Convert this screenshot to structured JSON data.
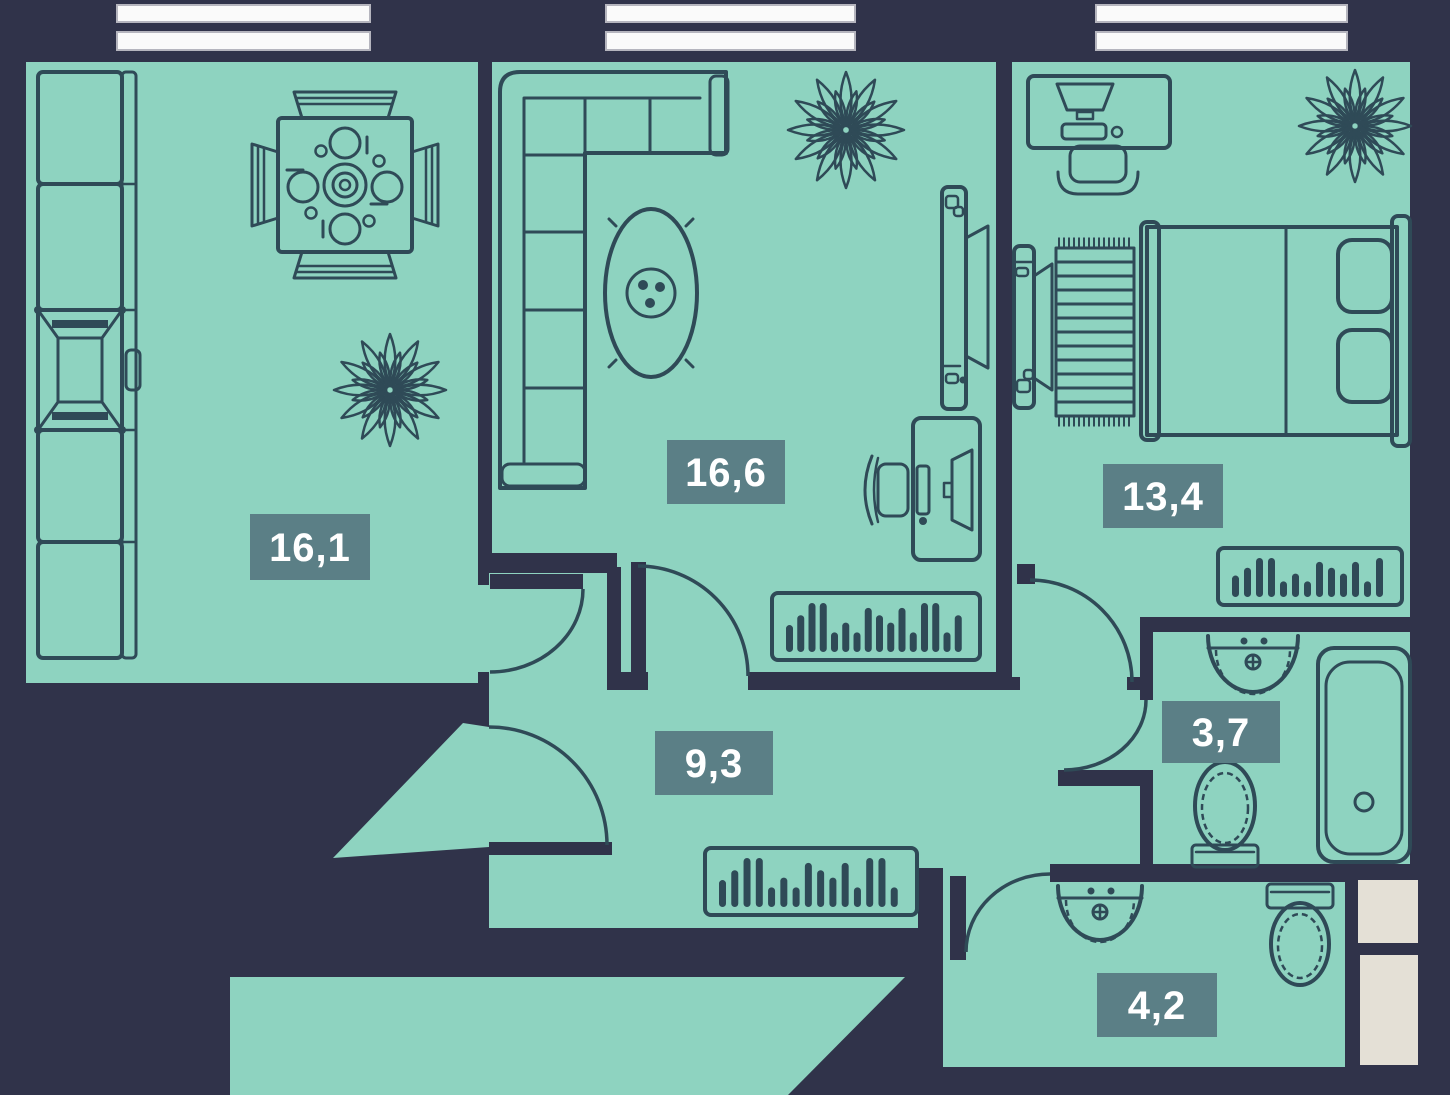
{
  "title": "Apartment floor plan",
  "colors": {
    "background": "#30334a",
    "room_fill": "#8ed3c0",
    "outline": "#2f4a57",
    "badge_fill": "#5b7f86",
    "badge_text": "#ffffff",
    "window_fill": "#fafafa",
    "window_border": "#b5b5be",
    "shaft_fill": "#e4e0d6"
  },
  "rooms": [
    {
      "id": "kitchen-dining",
      "area_label": "16,1"
    },
    {
      "id": "living-room",
      "area_label": "16,6"
    },
    {
      "id": "bedroom",
      "area_label": "13,4"
    },
    {
      "id": "hallway",
      "area_label": "9,3"
    },
    {
      "id": "bathroom",
      "area_label": "3,7"
    },
    {
      "id": "toilet-room",
      "area_label": "4,2"
    }
  ],
  "furniture": {
    "kitchen_dining": [
      "kitchen-counter-icon",
      "stove-icon",
      "dining-table-icon",
      "dining-chair-icon",
      "plant-icon"
    ],
    "living_room": [
      "corner-sofa-icon",
      "coffee-table-icon",
      "tv-console-icon",
      "desk-icon",
      "desk-chair-icon",
      "sideboard-icon",
      "plant-icon"
    ],
    "bedroom": [
      "desk-icon",
      "desk-chair-icon",
      "double-bed-icon",
      "rug-icon",
      "tv-console-icon",
      "sideboard-icon",
      "plant-icon"
    ],
    "hallway": [
      "sideboard-icon"
    ],
    "bathroom": [
      "sink-icon",
      "toilet-icon",
      "bathtub-icon"
    ],
    "toilet_room": [
      "sink-icon",
      "toilet-icon"
    ]
  },
  "windows": {
    "count": 3
  },
  "doors": {
    "count": 6
  },
  "shafts": {
    "count": 2
  }
}
